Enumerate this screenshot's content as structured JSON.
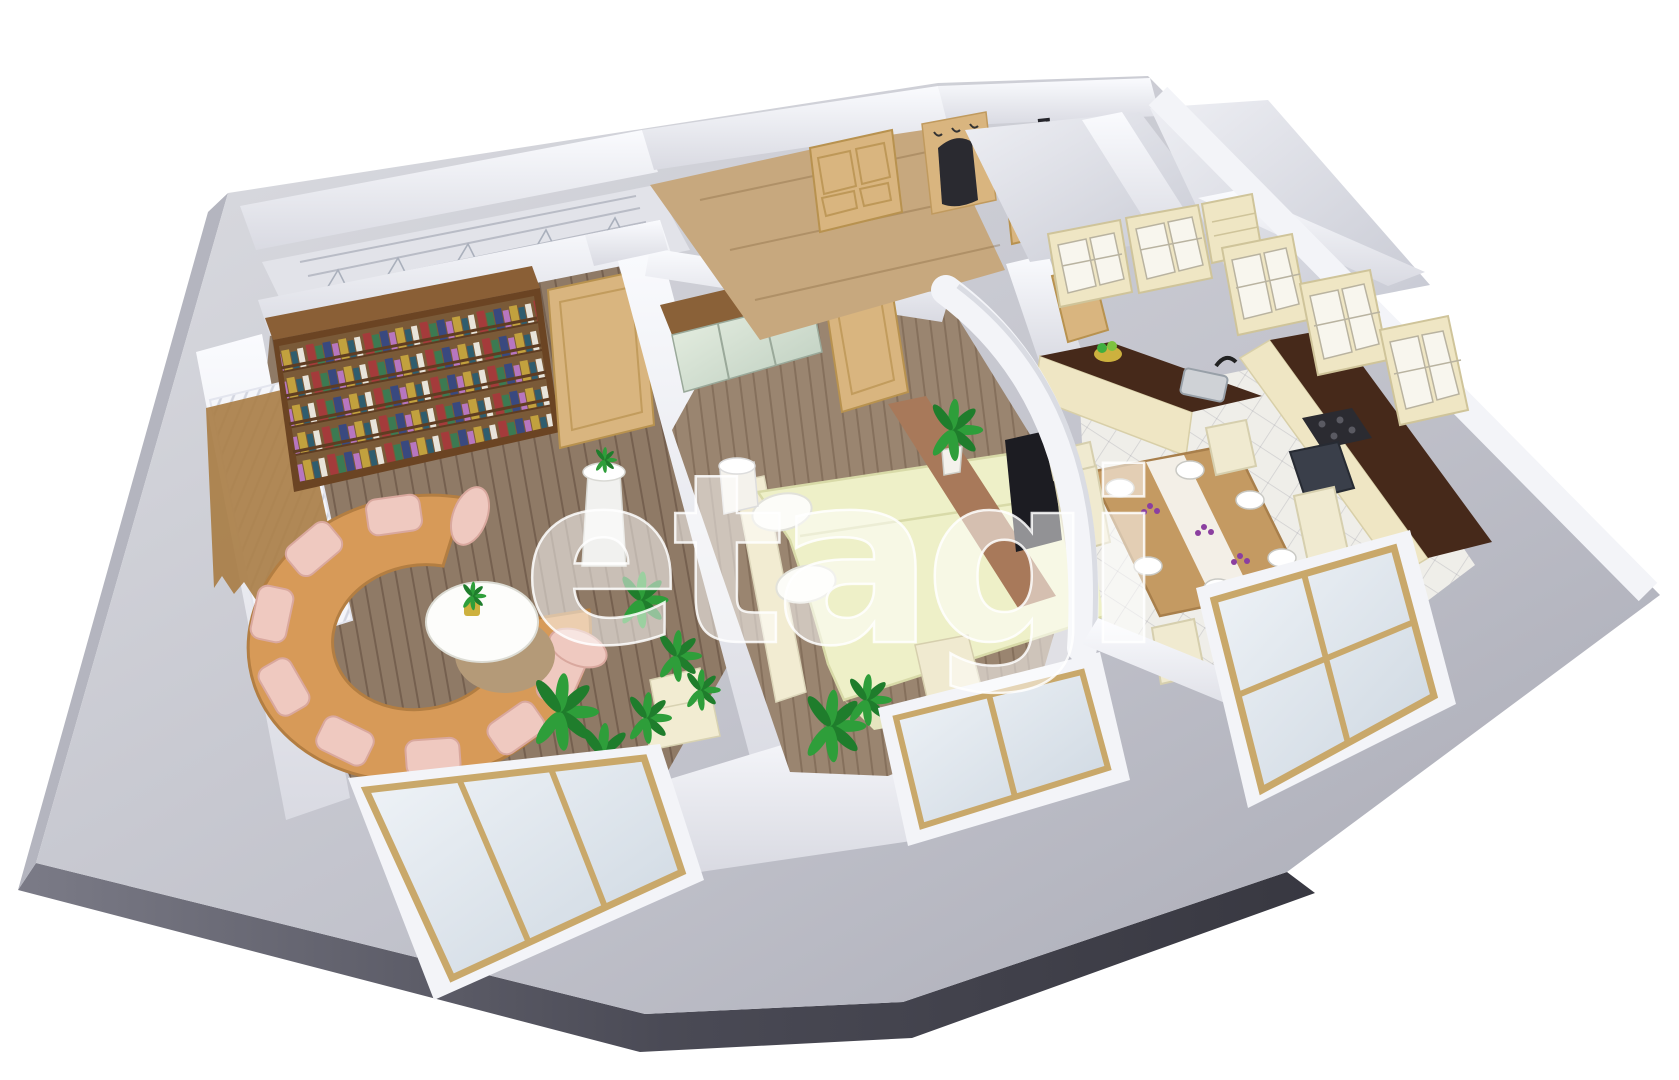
{
  "watermark": {
    "text": "etagi"
  },
  "scene": {
    "wall_mark": "7",
    "colors": {
      "background": "#ffffff",
      "slab_top": "#c9cad2",
      "slab_top_light": "#e9eaf0",
      "slab_side": "#41414c",
      "slab_side_light": "#8c8c98",
      "wall": "#f3f4f8",
      "wall_shade": "#d4d5de",
      "floor_living": "#8f7a66",
      "floor_bedroom": "#9a8570",
      "floor_hall": "#c7a87e",
      "floor_tile": "#efeee9",
      "floor_bath": "#dfe0e8",
      "loggia_floor": "#e2e3e9",
      "door_wood": "#d9b57f",
      "door_wood_edge": "#b8924f",
      "bookshelf_wood": "#6b4423",
      "bookshelf_top": "#8a5f36",
      "curtain_valance": "#a97c44",
      "sofa_body": "#d79a58",
      "sofa_edge": "#b37e42",
      "sofa_cushion": "#efc9c0",
      "cushion_edge": "#d9a89e",
      "table_white_top": "#fdfdfb",
      "table_wood_base": "#b49a78",
      "bed_cover": "#eef0c8",
      "bed_cover_edge": "#d8daa8",
      "pillow_white": "#fcfcf8",
      "bench_cream": "#f2ecd2",
      "wardrobe_wood": "#8a6138",
      "mirror_tint": "#dfe9da",
      "tv_black": "#1c1c22",
      "console_wood": "#a8795a",
      "counter_top": "#46291a",
      "cabinet_cream": "#efe6c4",
      "cabinet_pane": "#f8f6ee",
      "oven_front": "#3a3f4a",
      "cooktop_dark": "#2b2b31",
      "sink_gray": "#cfd2d6",
      "table_wood": "#c49a62",
      "table_wood_edge": "#a87f4b",
      "chair_cream": "#f0ead0",
      "chair_edge": "#d6cfae",
      "plant_green": "#2e9e3a",
      "plant_green_dark": "#1f7d2c",
      "flower_purple": "#8b3fa0",
      "window_frame": "#c9a86a",
      "coat_dark": "#2a2a30",
      "pot_white": "#f4f2ec",
      "pedestal_white": "#f1f1ef"
    }
  }
}
